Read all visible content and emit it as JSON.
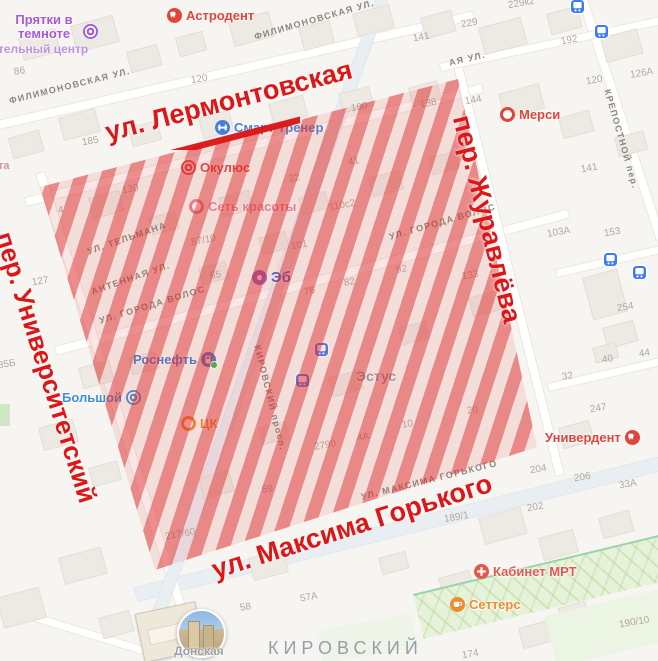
{
  "annotation": {
    "color": "#dd1717",
    "street_top": "ул. Лермонтовская",
    "street_right": "пер. Журавлёва",
    "street_bottom": "ул. Максима Горького",
    "street_left": "пер. Университетский"
  },
  "pois": [
    {
      "label": "Прятки в темноте",
      "sublabel": "тельный центр",
      "color": "#a55bd6"
    },
    {
      "label": "Астродент",
      "color": "#e0443a"
    },
    {
      "label": "Смарт Тренер",
      "color": "#4a7fd6"
    },
    {
      "label": "Окулюс",
      "color": "#e0443a"
    },
    {
      "label": "Сеть красоты",
      "color": "#e58396"
    },
    {
      "label": "Эб",
      "color": "#3b5bdb"
    },
    {
      "label": "Мерси",
      "color": "#e0443a"
    },
    {
      "label": "Роснефть",
      "color": "#3f7ad1"
    },
    {
      "label": "Большой",
      "color": "#3f8fd1"
    },
    {
      "label": "ЦК",
      "color": "#ef8b2e"
    },
    {
      "label": "Эстус",
      "color": "#939ba4"
    },
    {
      "label": "Универдент",
      "color": "#e0443a"
    },
    {
      "label": "Кабинет МРТ",
      "color": "#e4574a"
    },
    {
      "label": "Сеттерс",
      "color": "#ef8b2e"
    },
    {
      "label": "Донская",
      "color": "#9aa0a6"
    }
  ],
  "street_labels": [
    "ФИЛИМОНОВСКАЯ УЛ.",
    "ФИЛИМОНОВСКАЯ УЛ.",
    "АЯ УЛ.",
    "УЛ. ТЕЛЬМАНА",
    "АНТЕННАЯ УЛ.",
    "УЛ. ГОРОДА ВОЛОС",
    "УЛ. ГОРОДА ВОЛОС",
    "УЛ. МАКСИМА ГОРЬКОГО",
    "КРЕПОСТНОЙ пер.",
    "КИРОВСКИЙ просп."
  ],
  "district_label": "КИРОВСКИЙ",
  "house_numbers": [
    "86",
    "120",
    "185",
    "130",
    "4",
    "127",
    "35Б",
    "160",
    "138",
    "141",
    "229к2",
    "229",
    "192",
    "120",
    "126А",
    "144",
    "141",
    "153",
    "103А",
    "254",
    "40",
    "44",
    "32",
    "247",
    "110с2",
    "41",
    "22",
    "101",
    "87/10",
    "65",
    "82",
    "76",
    "92",
    "133",
    "59",
    "2790",
    "4А",
    "10",
    "217/60",
    "58",
    "57А",
    "204",
    "206",
    "202",
    "33А",
    "189/1",
    "20",
    "190/10",
    "174"
  ],
  "fragments": [
    "та"
  ]
}
